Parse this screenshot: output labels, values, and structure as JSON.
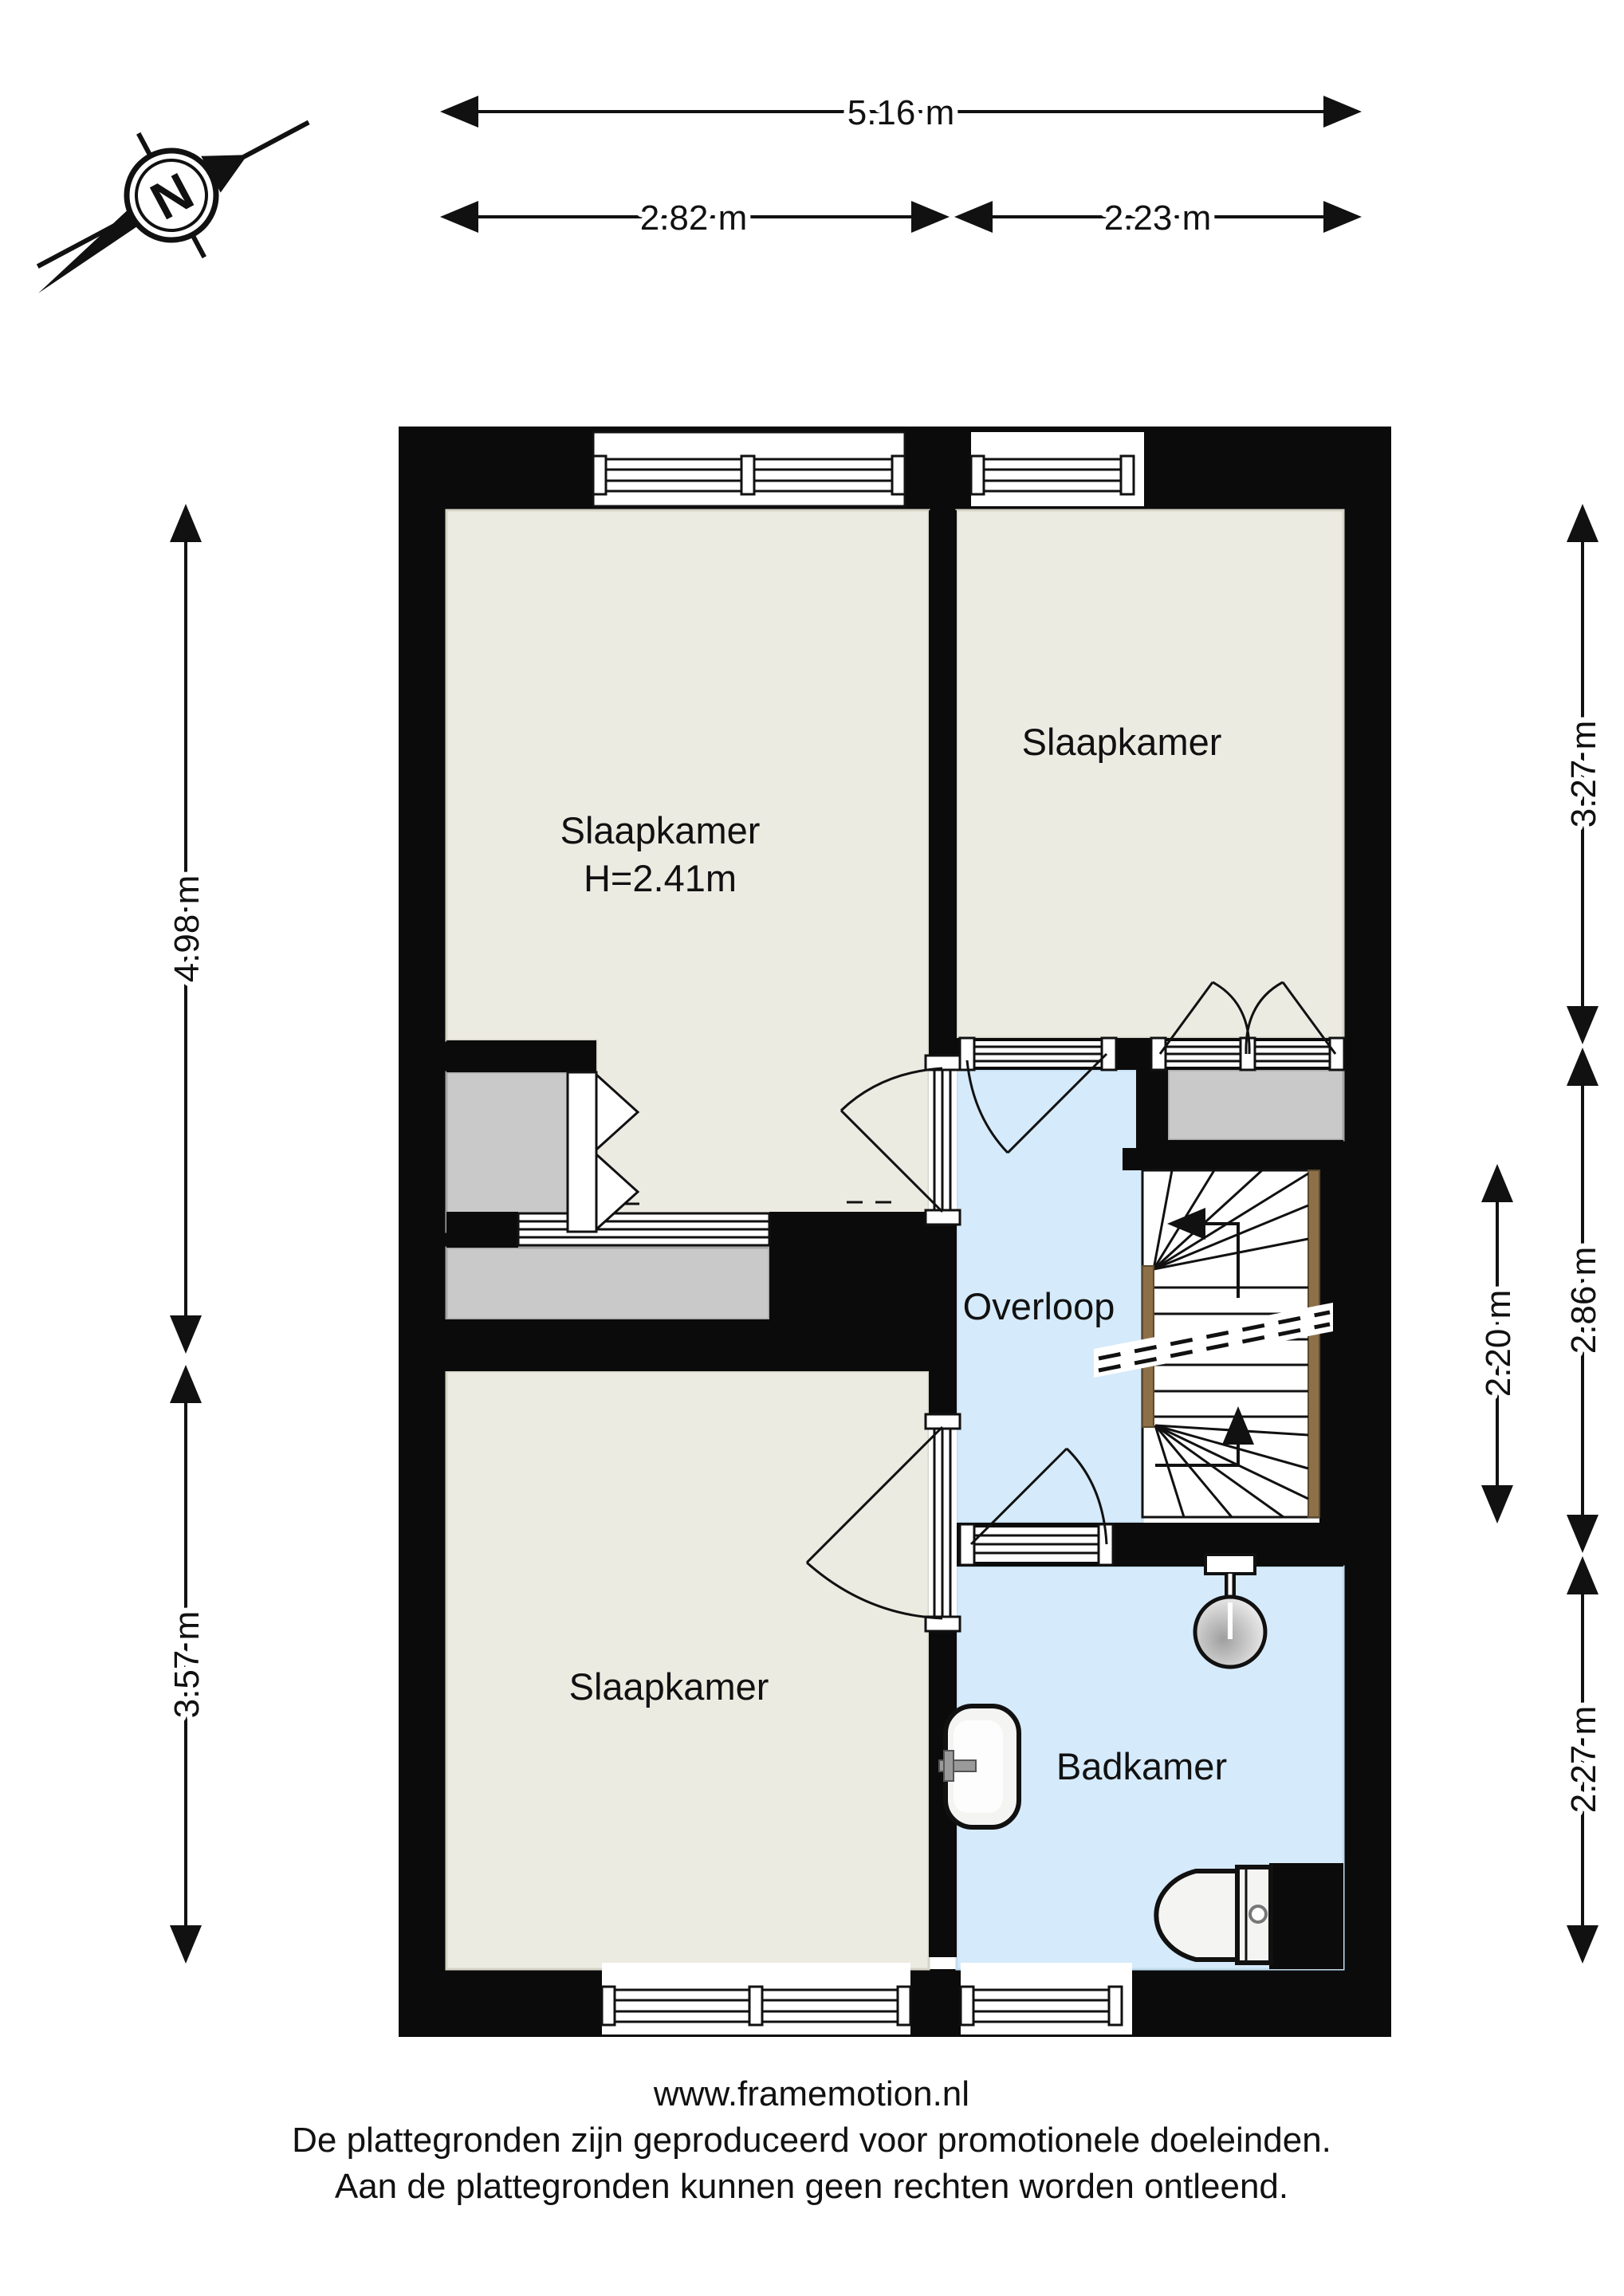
{
  "compass": {
    "letter": "N"
  },
  "dimensions": {
    "top_total": "5.16 m",
    "top_left": "2.82 m",
    "top_right": "2.23 m",
    "left_upper": "4.98 m",
    "left_lower": "3.57 m",
    "right_upper": "3.27 m",
    "right_middle": "2.86 m",
    "right_lower": "2.27 m",
    "stairwell": "2.20 m"
  },
  "rooms": {
    "bedroom_large": {
      "label": "Slaapkamer",
      "height_note": "H=2.41m"
    },
    "bedroom_topright": {
      "label": "Slaapkamer"
    },
    "bedroom_bottom": {
      "label": "Slaapkamer"
    },
    "landing": {
      "label": "Overloop"
    },
    "bathroom": {
      "label": "Badkamer"
    }
  },
  "footer": {
    "website": "www.framemotion.nl",
    "line1": "De plattegronden zijn geproduceerd voor promotionele doeleinden.",
    "line2": "Aan de plattegronden kunnen geen rechten worden ontleend."
  },
  "colors": {
    "wall": "#0b0b0b",
    "floor": "#ecebe2",
    "floor_border": "#d6d4c6",
    "water": "#d5eafa",
    "closet_gray": "#c9c9c9",
    "wood": "#8e7048",
    "line": "#111111"
  }
}
